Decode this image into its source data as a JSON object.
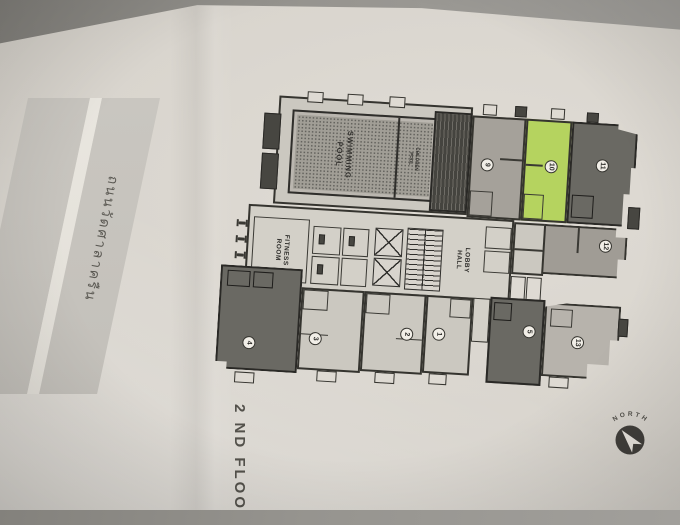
{
  "document": {
    "floor_label": "2 ND FLOOR"
  },
  "road": {
    "name": "ถนนวัดศาลาครืน"
  },
  "compass": {
    "label": "NORTH"
  },
  "plan": {
    "labels": {
      "swimming_pool": "SWIMMING\nPOOL",
      "children_pool": "CHILDREN\nPOOL",
      "fitness_room": "FITNESS\nROOM",
      "lobby_hall": "LOBBY\nHALL"
    },
    "unit_numbers": {
      "u1": "1",
      "u2": "2",
      "u3": "3",
      "u4": "4",
      "u5": "5",
      "u9": "9",
      "u10": "10",
      "u11": "11",
      "u12": "12",
      "u13": "13"
    },
    "highlighted_unit": "10"
  },
  "colors": {
    "highlight_green": "#b5d35f",
    "paper": "#d8d4cd",
    "wall": "#2f2e2b",
    "dark_unit": "#6a6963",
    "light_unit": "#cbc8c0"
  }
}
